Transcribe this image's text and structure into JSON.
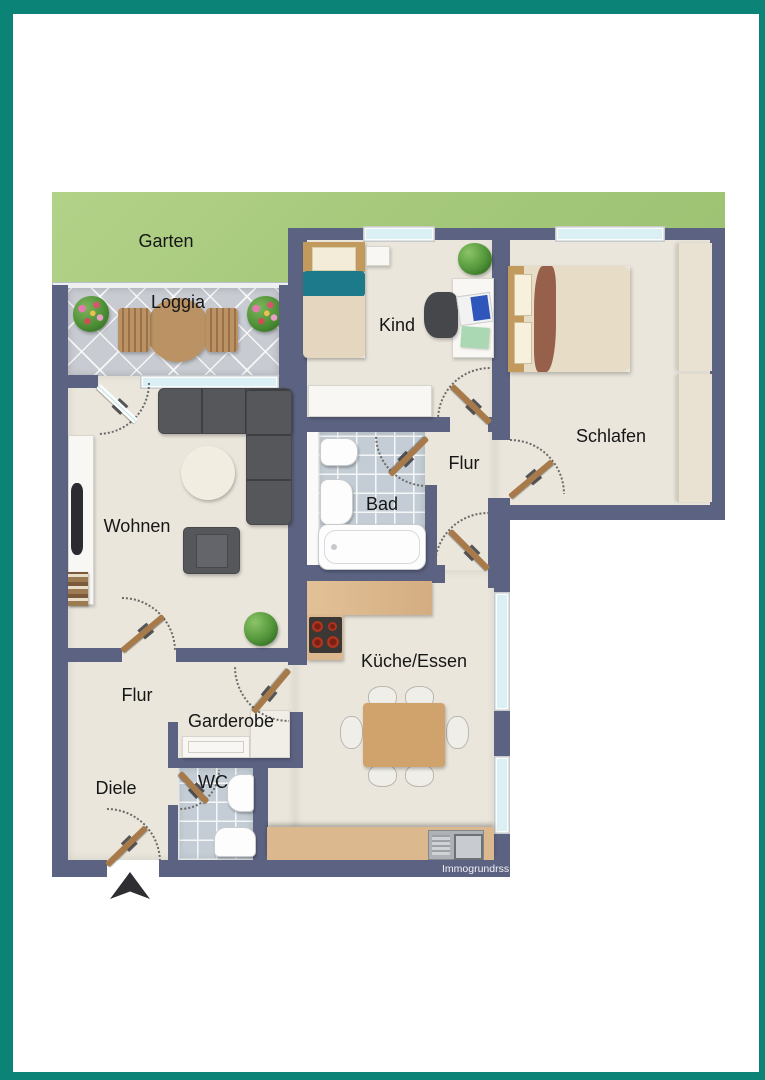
{
  "labels": {
    "garten": "Garten",
    "loggia": "Loggia",
    "kind": "Kind",
    "schlafen": "Schlafen",
    "flur_top": "Flur",
    "bad": "Bad",
    "wohnen": "Wohnen",
    "kueche": "Küche/Essen",
    "flur_bottom": "Flur",
    "garderobe": "Garderobe",
    "wc": "WC",
    "diele": "Diele"
  },
  "watermark": "Immogrundrss",
  "colors": {
    "frame": "#0b8376",
    "wall": "#5c6382",
    "floor": "#eae6dc",
    "garden": "#a6c97c",
    "tile": "#c8ccd2",
    "glass": "#daf0f5",
    "door": "#a87a4a",
    "counter": "#dcb88e",
    "table": "#cfa36b",
    "sofa": "#56575b",
    "accent_teal": "#1d7a8a",
    "blanket_brown": "#96604a"
  }
}
